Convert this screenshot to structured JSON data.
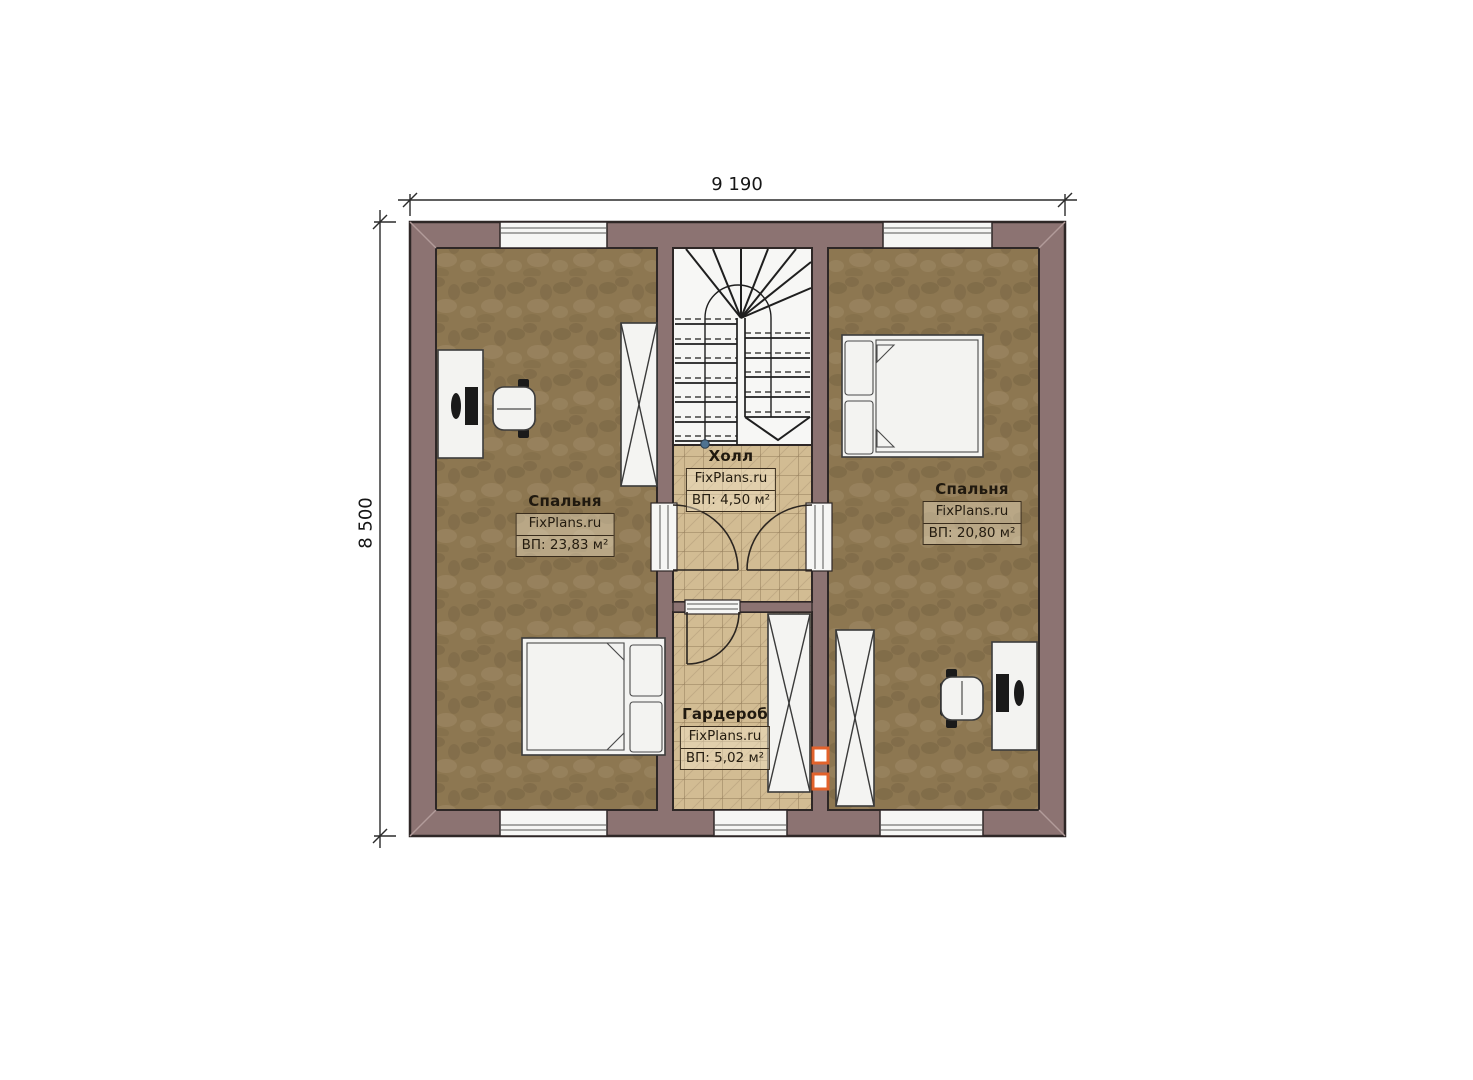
{
  "dimensions": {
    "width": "9 190",
    "height": "8 500"
  },
  "rooms": [
    {
      "id": "bedroom-left",
      "name": "Спальня",
      "brand": "FixPlans.ru",
      "area": "ВП: 23,83 м²"
    },
    {
      "id": "hall",
      "name": "Холл",
      "brand": "FixPlans.ru",
      "area": "ВП: 4,50 м²"
    },
    {
      "id": "bedroom-right",
      "name": "Спальня",
      "brand": "FixPlans.ru",
      "area": "ВП: 20,80 м²"
    },
    {
      "id": "wardrobe",
      "name": "Гардероб",
      "brand": "FixPlans.ru",
      "area": "ВП: 5,02 м²"
    }
  ],
  "colors": {
    "wall": "#8c7372",
    "carpet": "#8d7751",
    "tile": "#d2bc93",
    "accent": "#e2622b",
    "ink": "#20190f",
    "walkdot": "#4f7391"
  }
}
